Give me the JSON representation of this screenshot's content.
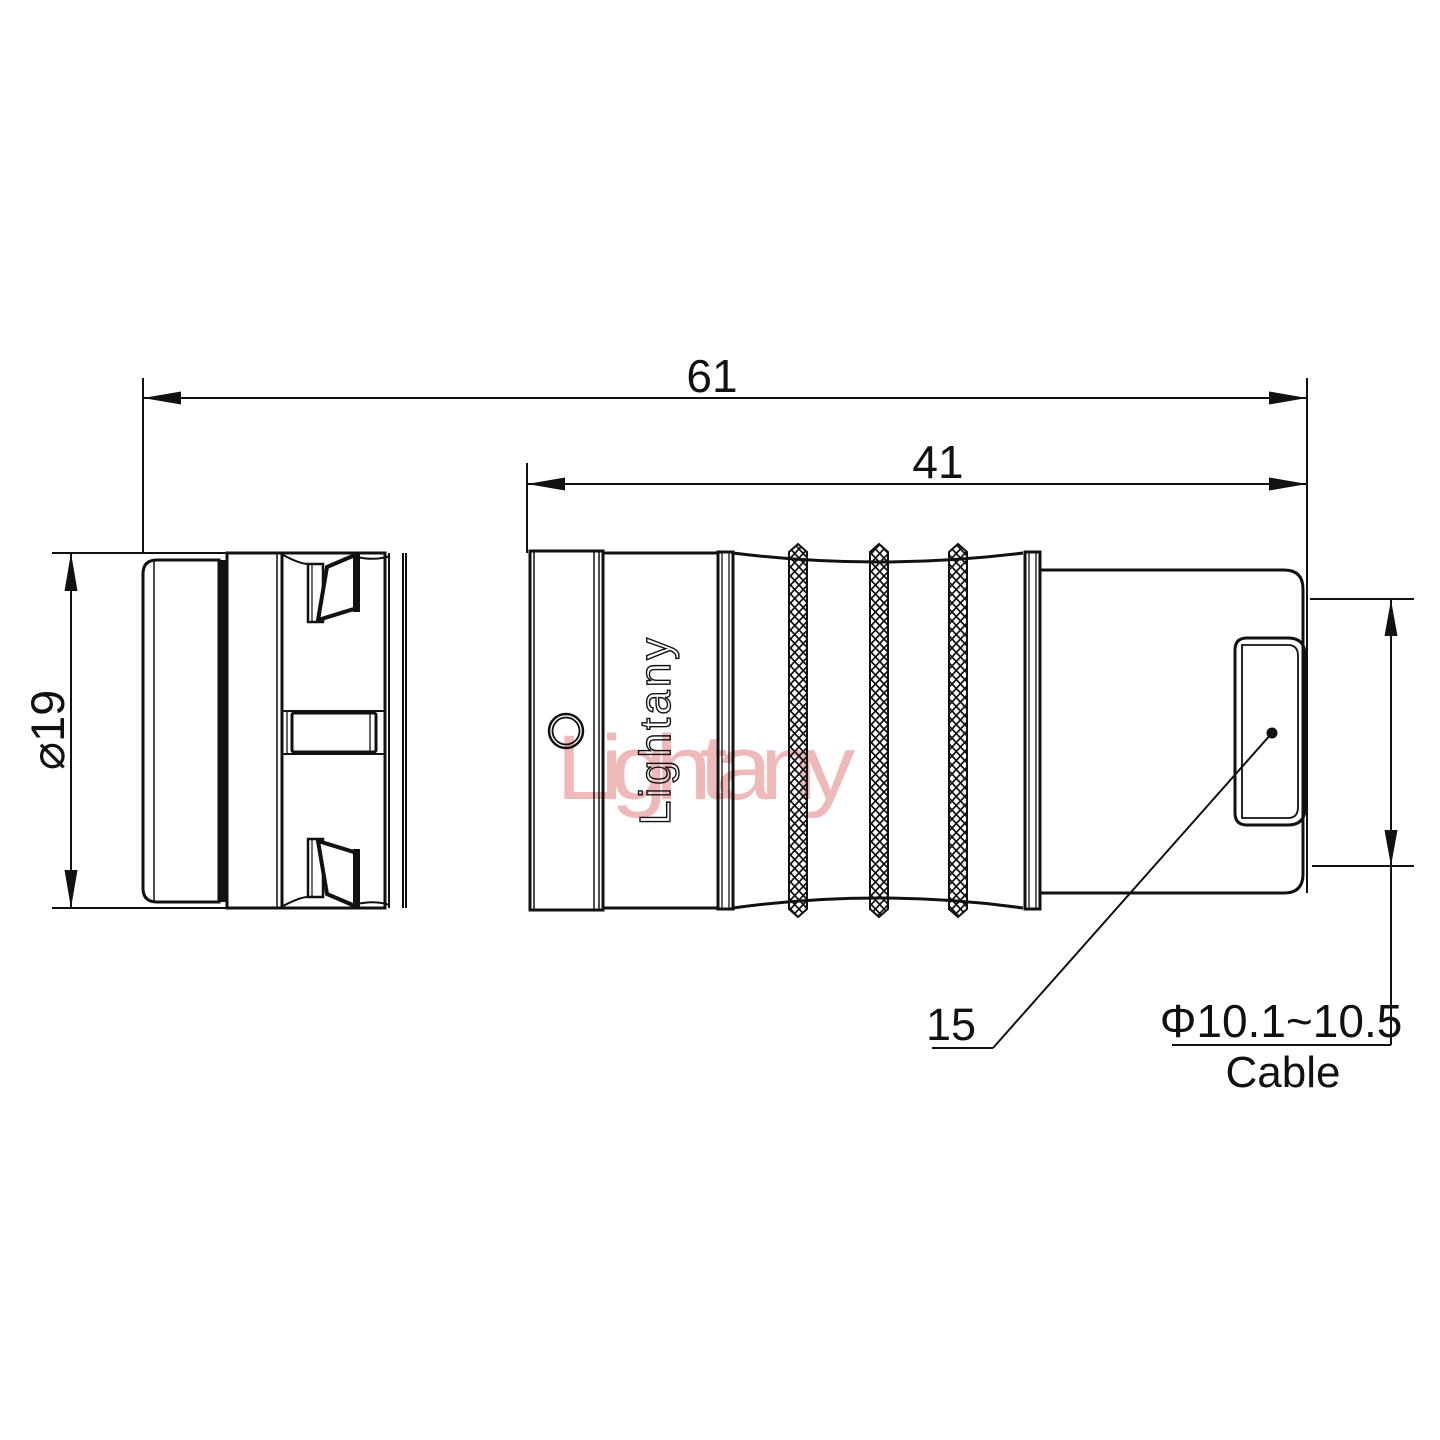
{
  "colors": {
    "background": "#ffffff",
    "line": "#111111",
    "watermark_pink": "#f0b9b9"
  },
  "dimensions": {
    "overall_length": "61",
    "rear_section_length": "41",
    "body_diameter": "⌀19",
    "boot_length": "15",
    "cable_diameter_range": "Φ10.1~10.5",
    "cable_caption": "Cable"
  },
  "branding": {
    "engraving": "Lightany",
    "watermark": "Lightany"
  }
}
